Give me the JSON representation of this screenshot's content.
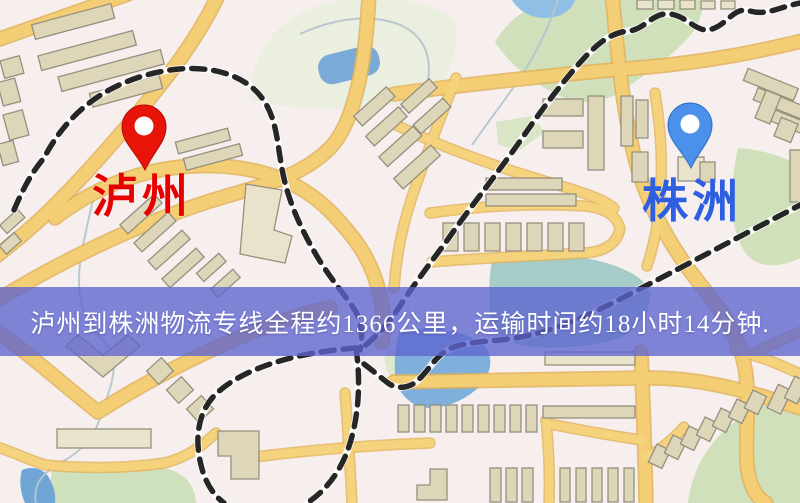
{
  "map_image": {
    "origin": {
      "label": "泸州",
      "pin_icon": "red-map-pin",
      "pin_color": "#e81408",
      "label_color": "#e60000"
    },
    "destination": {
      "label": "株洲",
      "pin_icon": "blue-map-pin",
      "pin_color": "#4b90ea",
      "label_color": "#2e5fe0"
    },
    "banner": {
      "text": "泸州到株洲物流专线全程约1366公里，运输时间约18小时14分钟.",
      "background_color": "#5e64cf",
      "text_color": "#ffffff"
    },
    "palette": {
      "map_background": "#f6efee",
      "road": "#f4ce74",
      "road_casing": "#e2b159",
      "building": "#ded6b8",
      "park_green": "#cfe0ba",
      "water_blue": "#7aabd8",
      "railway": "#262626"
    }
  }
}
